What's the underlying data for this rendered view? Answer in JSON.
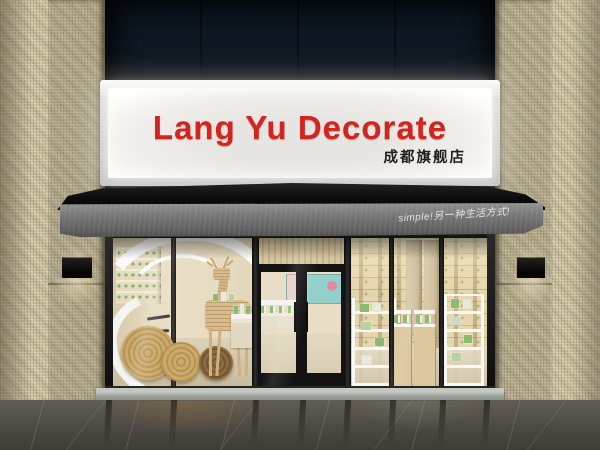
{
  "sign": {
    "title": "Lang Yu Decorate",
    "subtitle": "成都旗舰店"
  },
  "awning": {
    "slogan": "simple!另一种生活方式!"
  },
  "colors": {
    "sign_title_red": "#d32420",
    "sign_panel": "#efeeea",
    "awning_canopy": "#0c0c0c",
    "awning_valance": "#787878",
    "tile_wall": "#c6bc9b",
    "top_recess": "#0e1a26",
    "window_frame": "#141414",
    "interior_wall": "#e9ddc4",
    "accent_product_green": "#8abb70",
    "marble_floor": "#4c4944"
  }
}
